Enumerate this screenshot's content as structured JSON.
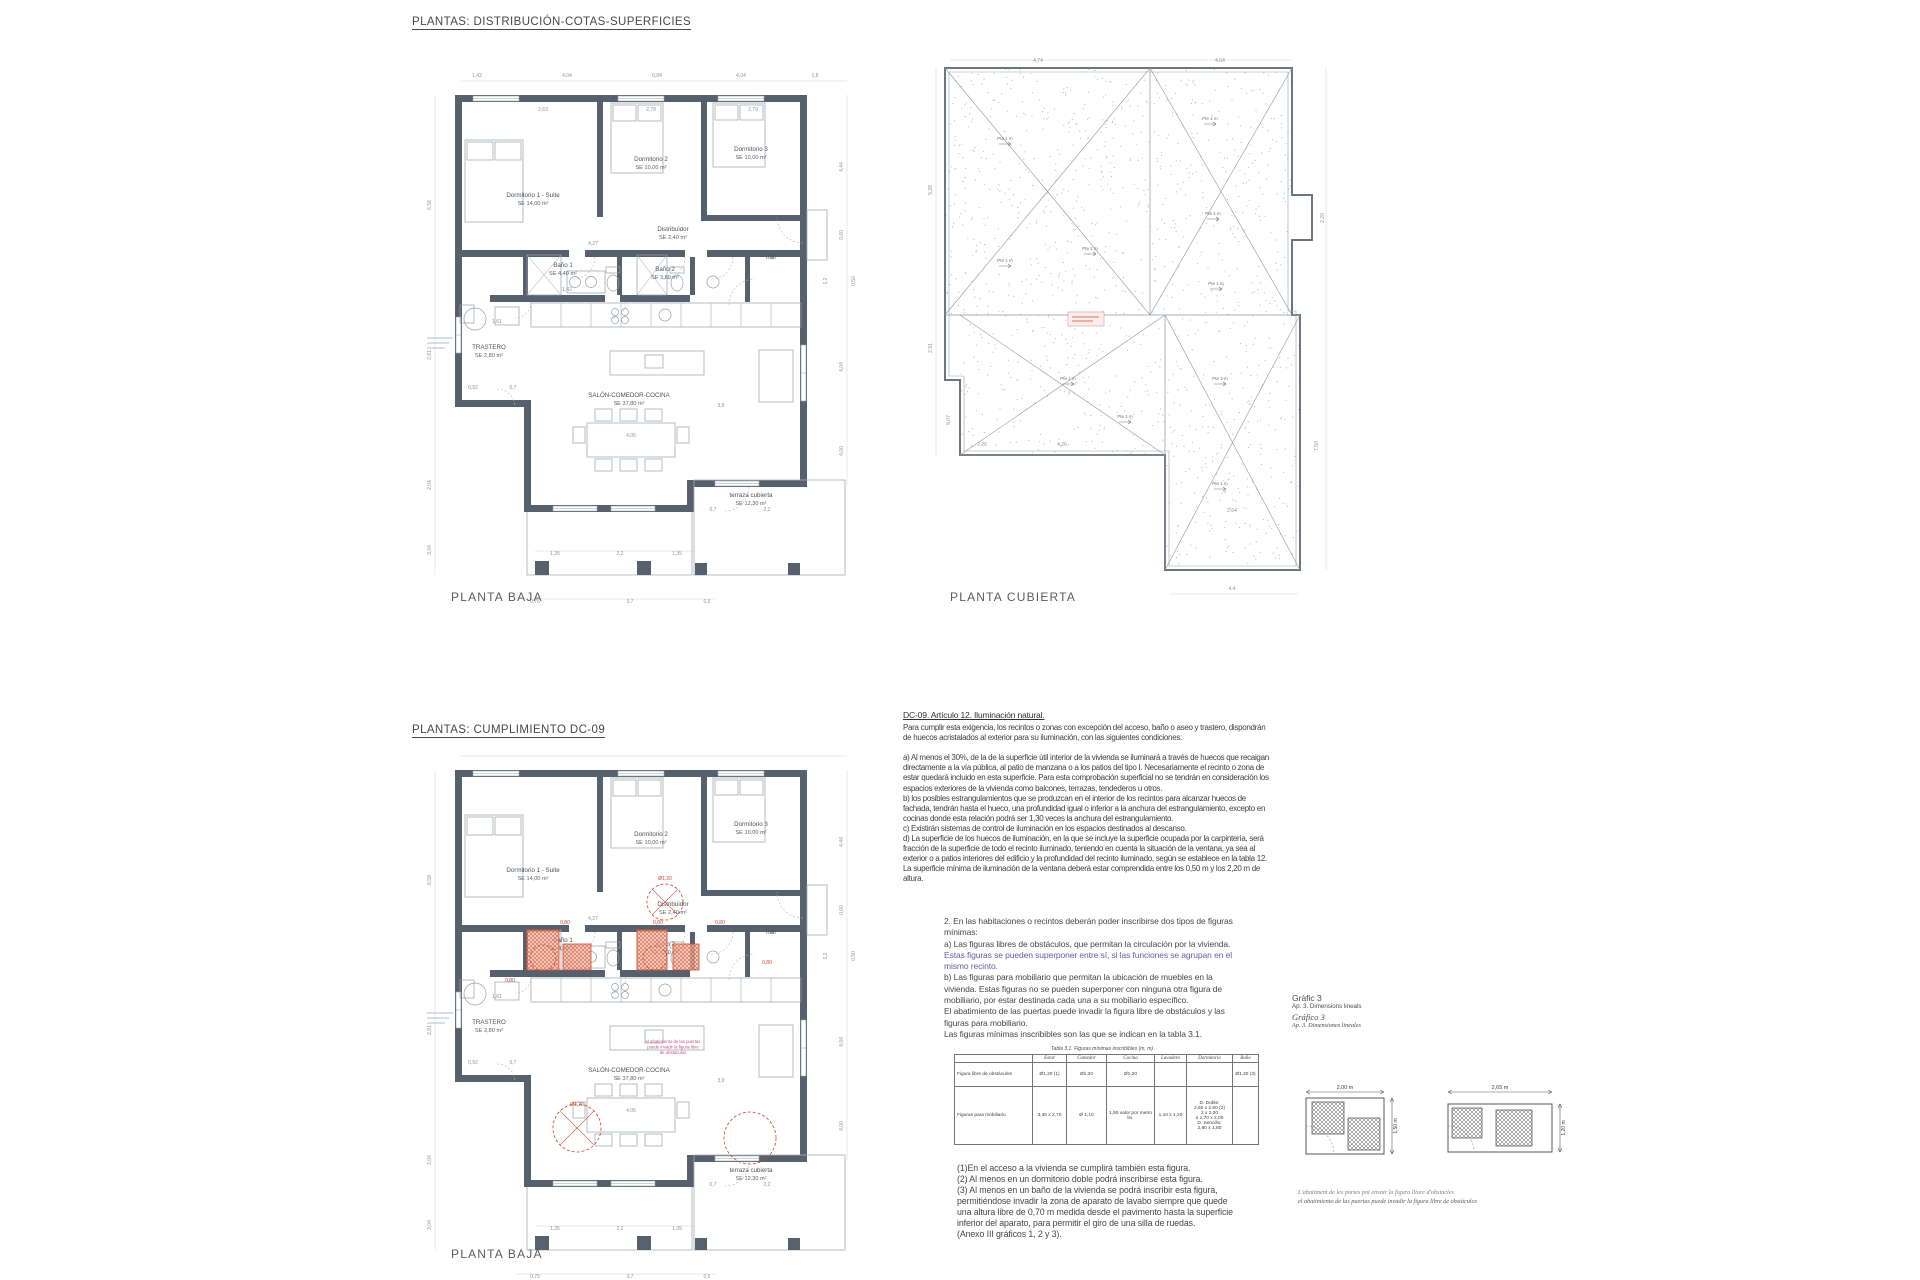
{
  "titles": {
    "sheet1": "PLANTAS: DISTRIBUCIÓN-COTAS-SUPERFICIES",
    "sheet2": "PLANTAS: CUMPLIMIENTO DC-09"
  },
  "captions": {
    "plan1": "PLANTA BAJA",
    "roof": "PLANTA CUBIERTA",
    "plan2": "PLANTA BAJA"
  },
  "colors": {
    "wall": "#57606d",
    "fixture": "#97a0a8",
    "dim": "#8b949c",
    "label": "#4d545b",
    "red": "#c8462f",
    "salmon": "#f2b79e",
    "magenta": "#c0527e",
    "stipple": "#b6bdc4"
  },
  "plan": {
    "rooms": [
      {
        "name": "Dormitorio 1 - Suite",
        "area": "SE 14,00 m²",
        "x": 118,
        "y": 142
      },
      {
        "name": "Dormitorio 2",
        "area": "SE 10,00 m²",
        "x": 236,
        "y": 106
      },
      {
        "name": "Dormitorio 3",
        "area": "SE 10,00 m²",
        "x": 336,
        "y": 96
      },
      {
        "name": "Distribuidor",
        "area": "SE 2,40 m²",
        "x": 258,
        "y": 176
      },
      {
        "name": "Baño 1",
        "area": "SE 4,40 m²",
        "x": 148,
        "y": 212
      },
      {
        "name": "Baño 2",
        "area": "SE 3,80 m²",
        "x": 250,
        "y": 216
      },
      {
        "name": "hall",
        "area": "",
        "x": 356,
        "y": 204
      },
      {
        "name": "TRASTERO",
        "area": "SE 2,80 m²",
        "x": 74,
        "y": 294
      },
      {
        "name": "SALÓN-COMEDOR-COCINA",
        "area": "SE 37,80 m²",
        "x": 214,
        "y": 342
      },
      {
        "name": "terraza cubierta",
        "area": "SE 12,30 m²",
        "x": 336,
        "y": 442
      }
    ],
    "dims": [
      {
        "t": "1,42",
        "x": 62,
        "y": 22
      },
      {
        "t": "4,04",
        "x": 152,
        "y": 22
      },
      {
        "t": "0,84",
        "x": 242,
        "y": 22
      },
      {
        "t": "4,04",
        "x": 326,
        "y": 22
      },
      {
        "t": "1,8",
        "x": 400,
        "y": 22
      },
      {
        "t": "2,63",
        "x": 128,
        "y": 56
      },
      {
        "t": "2,79",
        "x": 236,
        "y": 56
      },
      {
        "t": "2,79",
        "x": 338,
        "y": 56
      },
      {
        "t": "6,58",
        "x": 16,
        "y": 150,
        "r": 1
      },
      {
        "t": "2,81",
        "x": 16,
        "y": 300,
        "r": 1
      },
      {
        "t": "2,04",
        "x": 16,
        "y": 430,
        "r": 1
      },
      {
        "t": "3,04",
        "x": 16,
        "y": 495,
        "r": 1
      },
      {
        "t": "4,44",
        "x": 428,
        "y": 112,
        "r": 1
      },
      {
        "t": "0,60",
        "x": 428,
        "y": 180,
        "r": 1
      },
      {
        "t": "1,2",
        "x": 412,
        "y": 226,
        "r": 1
      },
      {
        "t": "0,50",
        "x": 440,
        "y": 226,
        "r": 1
      },
      {
        "t": "4,04",
        "x": 428,
        "y": 312,
        "r": 1
      },
      {
        "t": "4,00",
        "x": 428,
        "y": 396,
        "r": 1
      },
      {
        "t": "4,27",
        "x": 178,
        "y": 190
      },
      {
        "t": "1,42",
        "x": 152,
        "y": 236
      },
      {
        "t": "1,61",
        "x": 82,
        "y": 268
      },
      {
        "t": "0,92",
        "x": 58,
        "y": 334
      },
      {
        "t": "0,7",
        "x": 98,
        "y": 334
      },
      {
        "t": "4,05",
        "x": 216,
        "y": 382
      },
      {
        "t": "3,9",
        "x": 306,
        "y": 352
      },
      {
        "t": "0,7",
        "x": 298,
        "y": 456
      },
      {
        "t": "2,2",
        "x": 352,
        "y": 456
      },
      {
        "t": "1,35",
        "x": 140,
        "y": 500
      },
      {
        "t": "2,2",
        "x": 205,
        "y": 500
      },
      {
        "t": "1,35",
        "x": 262,
        "y": 500
      },
      {
        "t": "0,75",
        "x": 120,
        "y": 548
      },
      {
        "t": "3,7",
        "x": 215,
        "y": 548
      },
      {
        "t": "0,5",
        "x": 292,
        "y": 548
      }
    ]
  },
  "roof": {
    "slope_label": "Pte 1 m",
    "dims": [
      {
        "t": "4,74",
        "x": 118,
        "y": 12
      },
      {
        "t": "4,04",
        "x": 300,
        "y": 12
      },
      {
        "t": "5,28",
        "x": 12,
        "y": 140,
        "r": 1
      },
      {
        "t": "2,91",
        "x": 12,
        "y": 298,
        "r": 1
      },
      {
        "t": "5,07",
        "x": 30,
        "y": 370,
        "r": 1
      },
      {
        "t": "2,20",
        "x": 404,
        "y": 168,
        "r": 1
      },
      {
        "t": "7,50",
        "x": 398,
        "y": 396,
        "r": 1
      },
      {
        "t": "4,4",
        "x": 312,
        "y": 540
      },
      {
        "t": "2,64",
        "x": 312,
        "y": 462
      },
      {
        "t": "4,26",
        "x": 142,
        "y": 396
      },
      {
        "t": "2,26",
        "x": 62,
        "y": 396
      }
    ]
  },
  "dc09": {
    "heading": "DC-09. Artículo 12. Iluminación natural.",
    "lines": [
      "Para cumplir esta exigencia, los recintos o zonas con excepción del acceso, baño o aseo y trastero, dispondrán",
      "de huecos acristalados al exterior para su iluminación, con las siguientes condiciones:",
      "",
      "a) Al menos el 30%, de la de la superficie útil interior de la vivienda se iluminará a través de huecos que recaigan",
      "directamente a la vía pública, al patio de manzana o a los patios del tipo I. Necesariamente el recinto o zona de",
      "estar quedará incluido en esta superficie. Para esta comprobación superficial no se tendrán en consideración los",
      "espacios exteriores de la vivienda como balcones, terrazas, tendederos u otros.",
      "b) los posibles estrangulamientos que se produzcan en el interior de los recintos para alcanzar huecos de",
      "fachada, tendrán hasta el hueco, una profundidad igual o inferior a la anchura del estrangulamiento, excepto en",
      "cocinas donde esta relación podrá ser 1,30 veces la anchura del estrangulamiento.",
      "c) Existirán sistemas de control de iluminación en los espacios destinados al descanso.",
      "d) La superficie de los huecos de iluminación, en la que se incluye la superficie ocupada por la carpintería, será",
      "fracción de la superficie de todo el recinto iluminado, teniendo en cuenta la situación de la ventana, ya sea al",
      "exterior o a patios interiores del edificio y la profundidad del recinto iluminado, según se establece en la tabla 12.",
      "La superficie mínima de iluminación de la ventana deberá estar comprendida entre los 0,50 m y los 2,20 m de",
      "altura."
    ]
  },
  "figuras": {
    "lines": [
      {
        "t": "2. En las habitaciones o recintos deberán poder inscribirse dos tipos de figuras"
      },
      {
        "t": "mínimas:"
      },
      {
        "t": "a) Las figuras libres de obstáculos, que permitan la circulación por la vivienda."
      },
      {
        "t": "Estas figuras se pueden superponer entre sí, si las funciones se agrupan en el",
        "c": "purple"
      },
      {
        "t": "mismo recinto.",
        "c": "purple"
      },
      {
        "t": "b) Las figuras para mobiliario que permitan la ubicación de muebles en la"
      },
      {
        "t": "vivienda. Estas figuras no se pueden superponer con ninguna otra figura de"
      },
      {
        "t": "mobiliario, por estar destinada cada una a su mobiliario específico."
      },
      {
        "t": "El abatimiento de las puertas puede invadir la figura libre de obstáculos y las"
      },
      {
        "t": "figuras para mobiliario."
      },
      {
        "t": "Las figuras mínimas inscribibles son las que se indican en la tabla 3.1."
      }
    ]
  },
  "grafico": {
    "lines": [
      {
        "t": "Gràfic 3",
        "s": "g-big"
      },
      {
        "t": "Ap. 3. Dimensions lineals",
        "s": "g-small"
      },
      {
        "t": "Gráfico 3",
        "s": "g-bigi"
      },
      {
        "t": "Ap. 3. Dimensiones lineales",
        "s": "g-smalli"
      }
    ]
  },
  "table": {
    "title": "Tabla 3.1. Figuras mínimas inscribibles (m, m)",
    "headers": [
      "",
      "Estar",
      "Comedor",
      "Cocina",
      "Lavadero",
      "Dormitorio",
      "Baño"
    ],
    "rows": [
      {
        "label": "Figura libre de obstáculos",
        "cells": [
          "Ø1,20 (1)",
          "Ø1,20",
          "Ø1,20",
          "",
          "",
          "Ø1,20 (3)"
        ]
      },
      {
        "label": "Figuras para mobiliario",
        "cells": [
          "3,30 x 2,70",
          "Ø 1,10",
          "1,90 valor por metro lin.",
          "1,10 x 1,20",
          "D. Doble:\n2,60 x 2,60 (2)\n2 x 2,00\nó 1,70 x 2,00\nD. Sencillo:\n2,90 x 1,80",
          ""
        ]
      }
    ]
  },
  "notes": [
    "(1)En el acceso a la vivienda se cumplirá también esta figura.",
    "(2) Al menos en un dormitorio doble podrá inscribirse esta figura.",
    "(3) Al menos en un baño de la vivienda se podrá inscribir esta figura,",
    "permitiéndose invadir la zona de aparato de lavabo siempre que quede",
    "una altura libre de 0,70 m medida desde el pavimento hasta la superficie",
    "inferior del aparato, para permitir el giro de una silla de ruedas.",
    "(Anexo III gráficos 1, 2 y 3)."
  ],
  "mini": {
    "left_w": "2,00 m",
    "left_h": "1,50 m",
    "right_w": "2,65 m",
    "right_h": "1,20 m",
    "caption1": "L'abatiment de les portes pot envair la figura lliure d'obstacles",
    "caption2": "el abatimiento de las puertas puede invadir la figura libre de obstáculos"
  },
  "plan2_overlay": {
    "red_dims": [
      {
        "t": "0,80",
        "x": 150,
        "y": 194
      },
      {
        "t": "0,80",
        "x": 243,
        "y": 194
      },
      {
        "t": "0,80",
        "x": 305,
        "y": 194
      },
      {
        "t": "0,80",
        "x": 95,
        "y": 252
      },
      {
        "t": "0,80",
        "x": 352,
        "y": 234
      },
      {
        "t": "Ø1,20",
        "x": 250,
        "y": 150
      },
      {
        "t": "Ø1,20",
        "x": 162,
        "y": 376
      }
    ],
    "note_lines": [
      "el abatimiento de las puertas",
      "puede invadir la figura libre",
      "de obstáculos"
    ]
  }
}
